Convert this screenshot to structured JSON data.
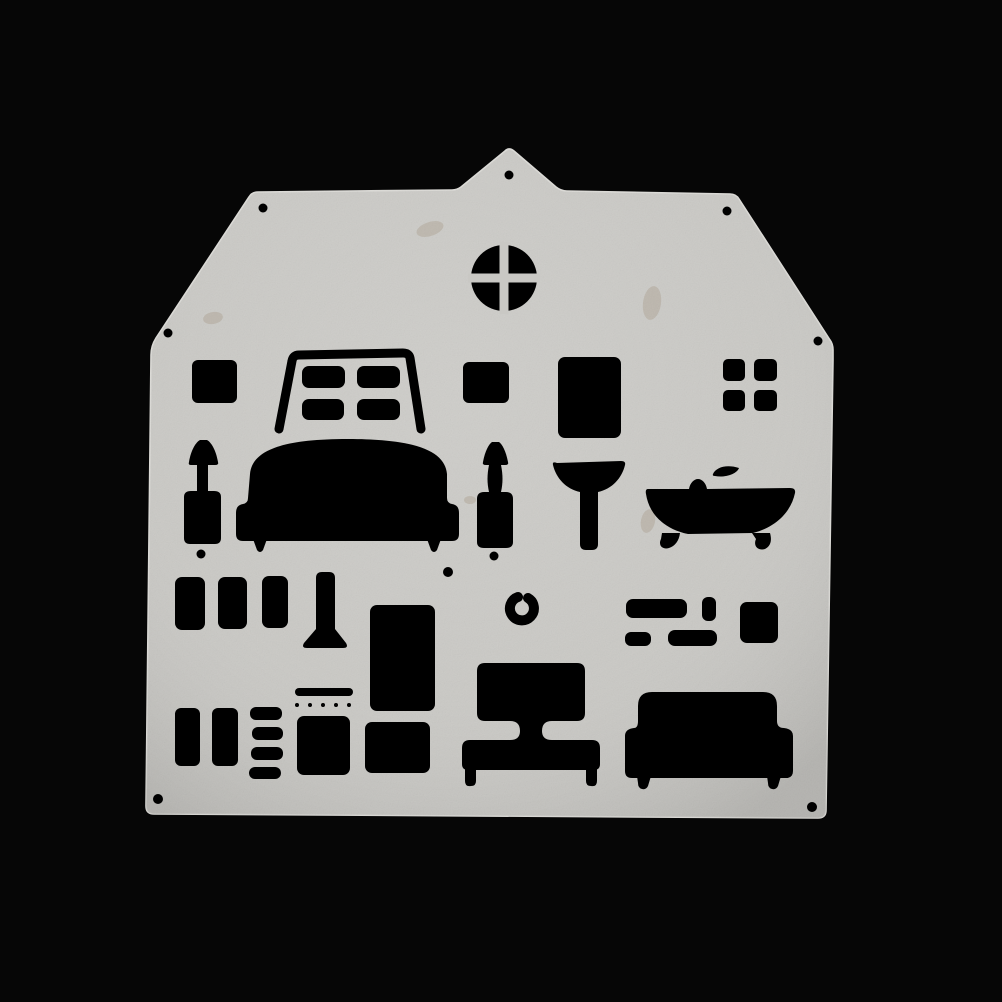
{
  "scene": {
    "description": "Silver house-shaped metal craft cutting die with dollhouse furniture cut-outs, photographed on a black background",
    "colors": {
      "background": "#060606",
      "plate": "#c9c8c4",
      "plate_edge": "#dbdad6",
      "cutout": "#000000",
      "stain": "#8e795c"
    }
  },
  "plate": {
    "label": "house-shaped cutting die plate",
    "features": [
      "pilot hole (7 around border)",
      "attic cross window",
      "small window blank",
      "four-pane window frame",
      "small window blank",
      "door panel blank",
      "four-pane grid window",
      "floor lamp",
      "sofa",
      "table lamp",
      "pedestal basin",
      "clawfoot bathtub with faucet",
      "drawer blanks (3)",
      "baluster leg",
      "wardrobe door",
      "wall hook",
      "shelf and cabinet blanks (5)",
      "drawer blanks (2)",
      "ladder slats (4)",
      "vent slot",
      "stitch dot row (5)",
      "dresser panel",
      "cabinet panel",
      "bed with headboard",
      "sofa bed",
      "registration dots (3)"
    ]
  }
}
